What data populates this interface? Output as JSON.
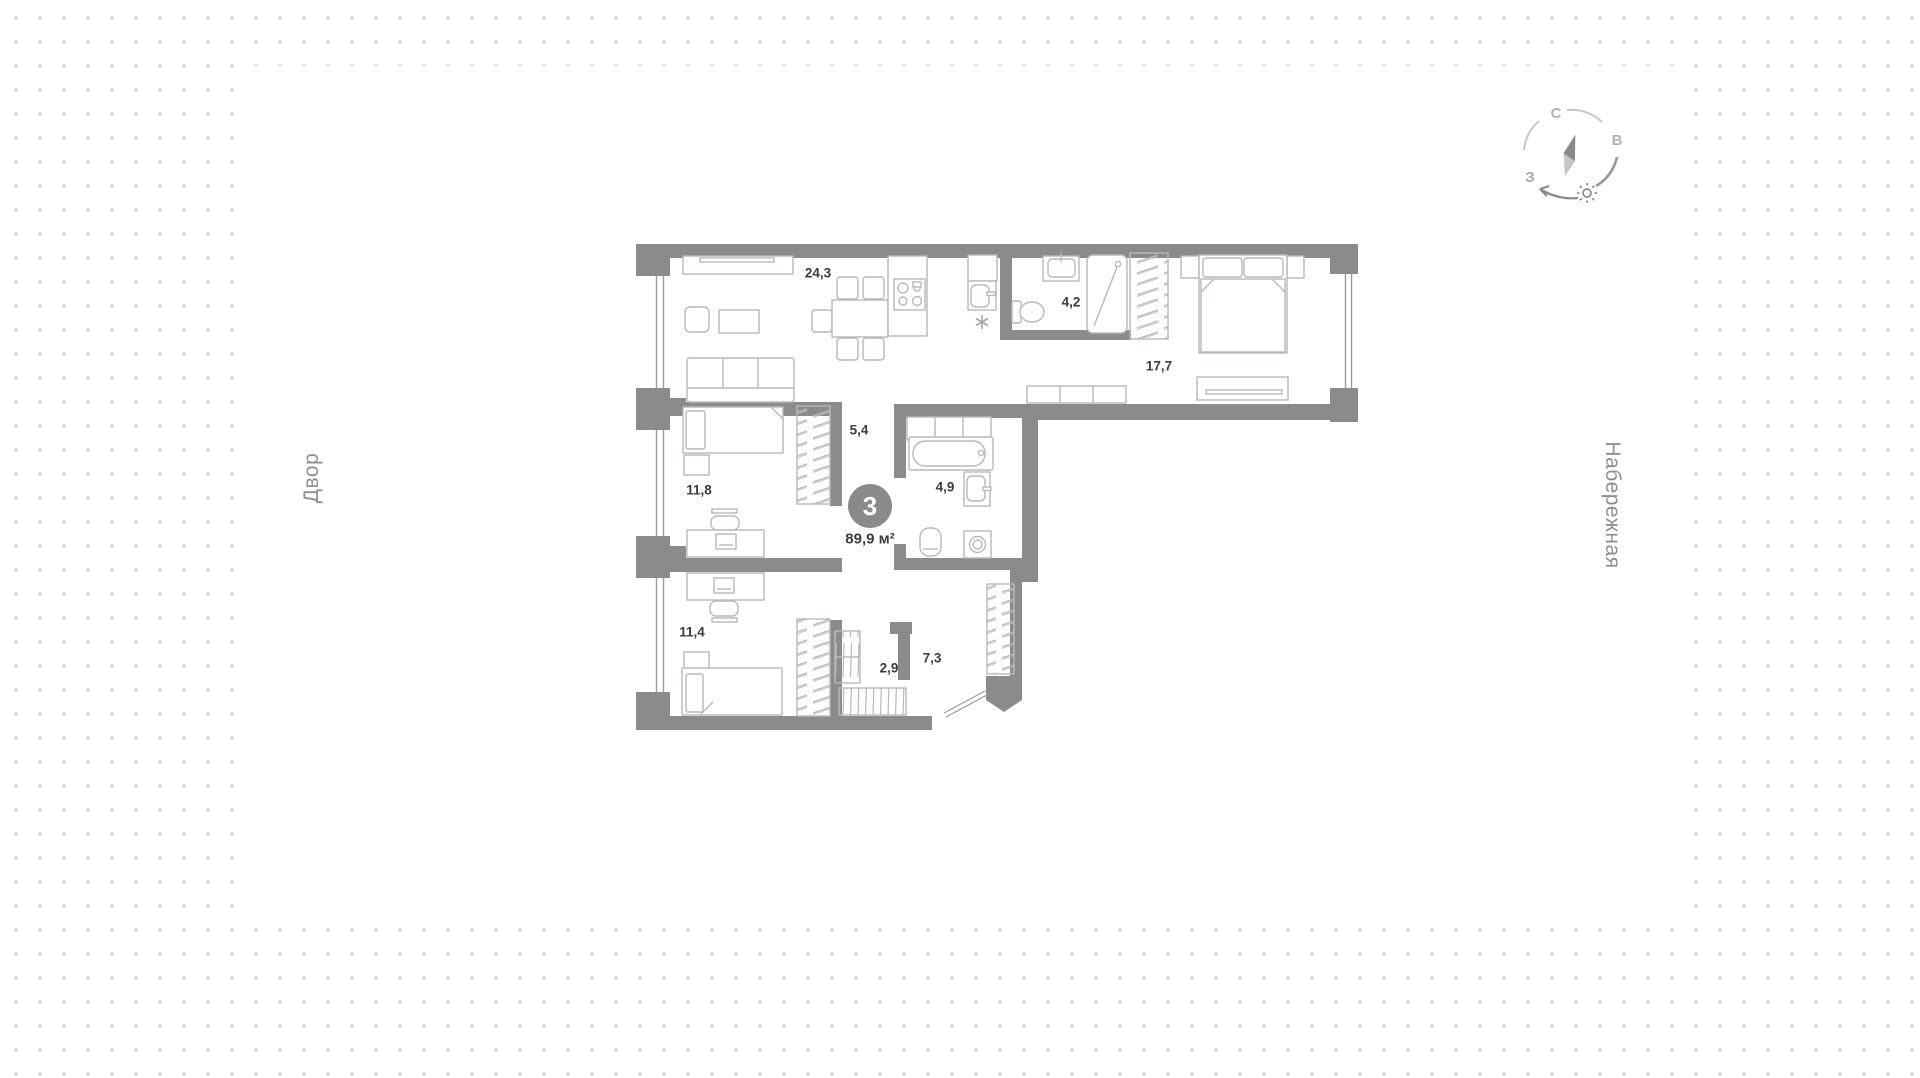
{
  "canvas": {
    "dot_color": "#c9c9c9",
    "wall_color": "#8b8b8b",
    "furniture_line_color": "#b5babc",
    "label_color": "#3c3c3c",
    "muted_text_color": "#8f8f8f"
  },
  "context": {
    "left_street": "Двор",
    "right_street": "Набережная"
  },
  "compass": {
    "north_label": "С",
    "east_label": "В",
    "west_label": "З"
  },
  "apartment": {
    "rooms_badge": "3",
    "total_area": "89,9 м²",
    "rooms": [
      {
        "name": "kitchen-living-room",
        "area": "24,3"
      },
      {
        "name": "bathroom-small",
        "area": "4,2"
      },
      {
        "name": "bedroom-master",
        "area": "17,7"
      },
      {
        "name": "hallway-inner",
        "area": "5,4"
      },
      {
        "name": "bedroom-left",
        "area": "11,8"
      },
      {
        "name": "bathroom-main",
        "area": "4,9"
      },
      {
        "name": "storage",
        "area": "2,9"
      },
      {
        "name": "hallway-entry",
        "area": "7,3"
      },
      {
        "name": "bedroom-bottom",
        "area": "11,4"
      }
    ]
  }
}
